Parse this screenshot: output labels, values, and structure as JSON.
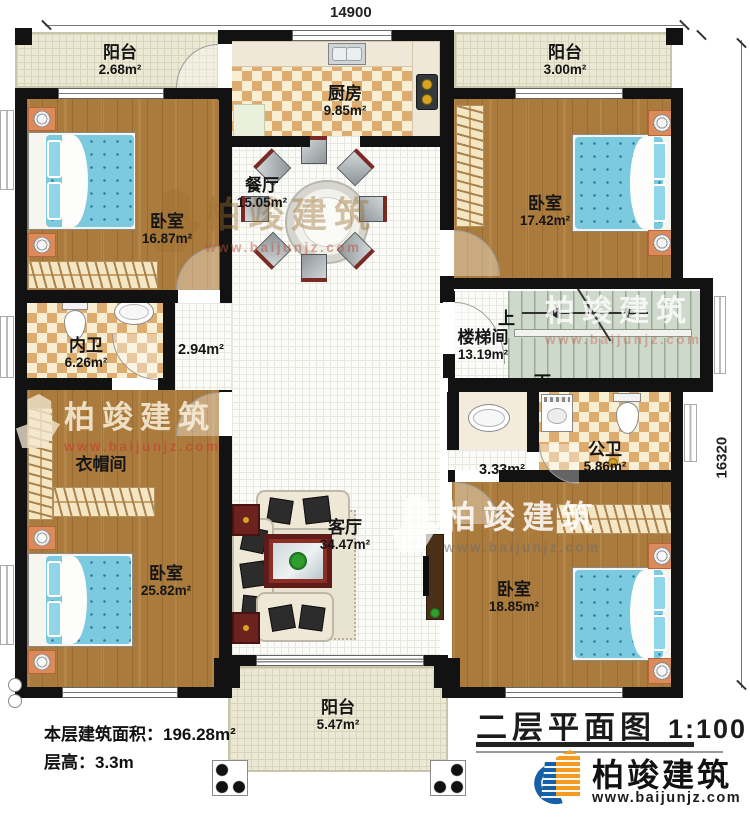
{
  "meta": {
    "plan_title": "二层平面图",
    "scale": "1:100",
    "floor_area": "本层建筑面积：196.28m²",
    "floor_height": "层高：3.3m"
  },
  "dimensions": {
    "width_mm": "14900",
    "height_mm": "16320"
  },
  "rooms": {
    "balcony_tl": {
      "name": "阳台",
      "area": "2.68m²"
    },
    "kitchen": {
      "name": "厨房",
      "area": "9.85m²"
    },
    "balcony_tr": {
      "name": "阳台",
      "area": "3.00m²"
    },
    "bedroom_tl": {
      "name": "卧室",
      "area": "16.87m²"
    },
    "dining": {
      "name": "餐厅",
      "area": "15.05m²"
    },
    "bedroom_tr": {
      "name": "卧室",
      "area": "17.42m²"
    },
    "bath_inner": {
      "name": "内卫",
      "area": "6.26m²"
    },
    "stairwell": {
      "name": "楼梯间",
      "area": "13.19m²"
    },
    "cloakroom": {
      "name": "衣帽间"
    },
    "bath_public": {
      "name": "公卫",
      "area": "5.86m²"
    },
    "bedroom_bl": {
      "name": "卧室",
      "area": "25.82m²"
    },
    "living": {
      "name": "客厅",
      "area": "34.47m²"
    },
    "bedroom_br": {
      "name": "卧室",
      "area": "18.85m²"
    },
    "balcony_b": {
      "name": "阳台",
      "area": "5.47m²"
    }
  },
  "halls": {
    "center": "2.94m²",
    "small": "3.33m²"
  },
  "stairs": {
    "up": "上",
    "down": "下"
  },
  "brand": {
    "name": "柏竣建筑",
    "url": "www.baijunjz.com"
  },
  "colors": {
    "wall": "#121212",
    "wood": "#ab7b3d",
    "tile": "#deac6f",
    "stair": "#cfd9cb",
    "bed": "#7ccadf",
    "logo_blue": "#1660a8",
    "logo_orange": "#f59b21",
    "watermark_red": "#c04a32"
  }
}
